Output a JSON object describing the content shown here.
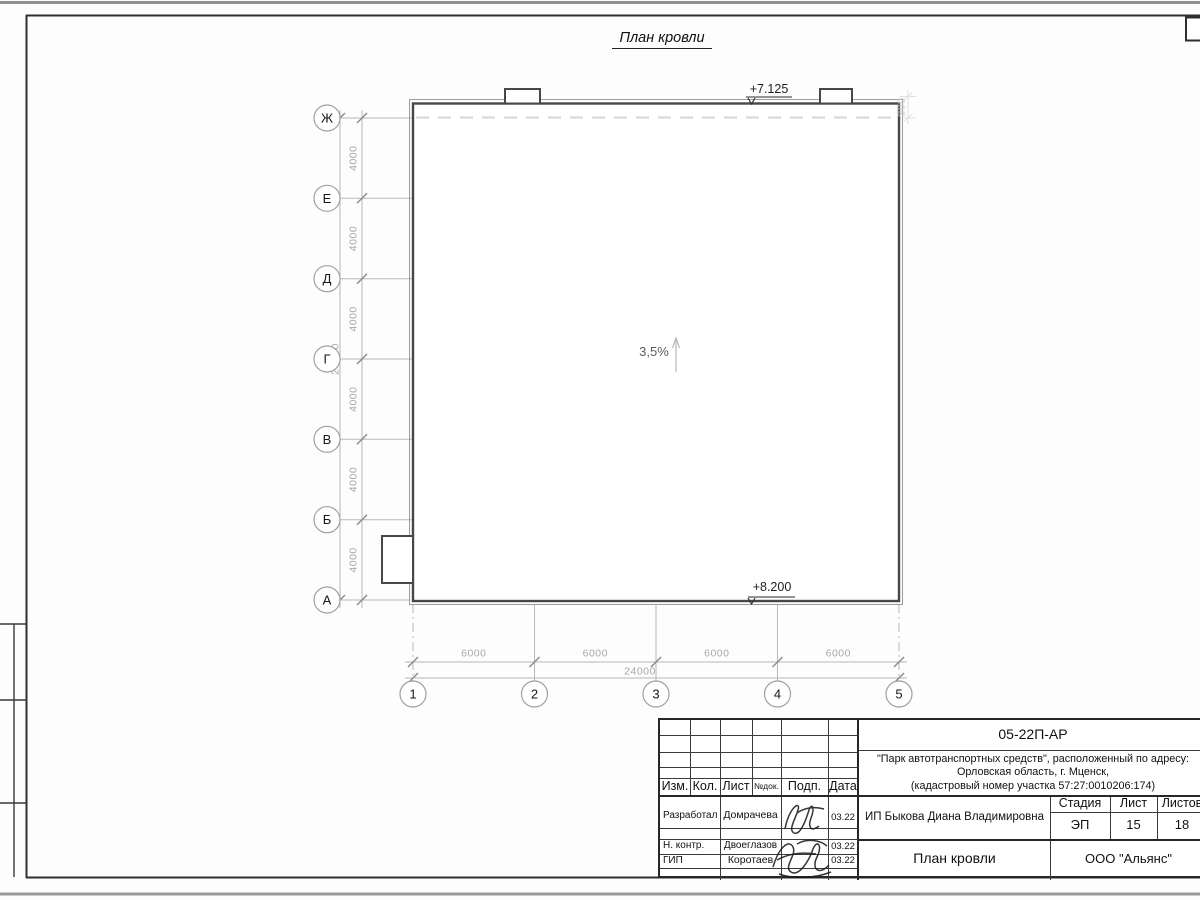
{
  "page": {
    "title": "План кровли"
  },
  "drawing": {
    "slope_label": "3,5%",
    "elevation_top": "+7.125",
    "elevation_bottom": "+8.200",
    "parapet_dim": "300",
    "row_axes": [
      "Ж",
      "Е",
      "Д",
      "Г",
      "В",
      "Б",
      "А"
    ],
    "col_axes": [
      "1",
      "2",
      "3",
      "4",
      "5"
    ],
    "row_dims": [
      "4000",
      "4000",
      "4000",
      "4000",
      "4000",
      "4000"
    ],
    "row_total": "24000",
    "col_dims": [
      "6000",
      "6000",
      "6000",
      "6000"
    ],
    "col_total": "24000"
  },
  "title_block": {
    "doc_number": "05-22П-АР",
    "project_lines": [
      "\"Парк автотранспортных средств\",  расположенный по адресу:",
      "Орловская область, г. Мценск,",
      "(кадастровый номер участка 57:27:0010206:174)"
    ],
    "columns": {
      "izm": "Изм.",
      "kol": "Кол.",
      "list": "Лист",
      "ndok": "№док.",
      "podp": "Подп.",
      "data": "Дата"
    },
    "rows": [
      {
        "role": "Разработал",
        "name": "Домрачева",
        "date": "03.22"
      },
      {
        "role": "Н. контр.",
        "name": "Двоеглазов",
        "date": "03.22"
      },
      {
        "role": "ГИП",
        "name": "Коротаев",
        "date": "03.22"
      }
    ],
    "client": "ИП Быкова Диана Владимировна",
    "stage_label": "Стадия",
    "sheet_label": "Лист",
    "sheets_label": "Листов",
    "stage": "ЭП",
    "sheet": "15",
    "sheets": "18",
    "sheet_title": "План кровли",
    "company": "ООО \"Альянс\""
  },
  "colors": {
    "line_dark": "#474747",
    "line_light": "#b8b8b8",
    "dim_text": "#a8a8a8"
  }
}
